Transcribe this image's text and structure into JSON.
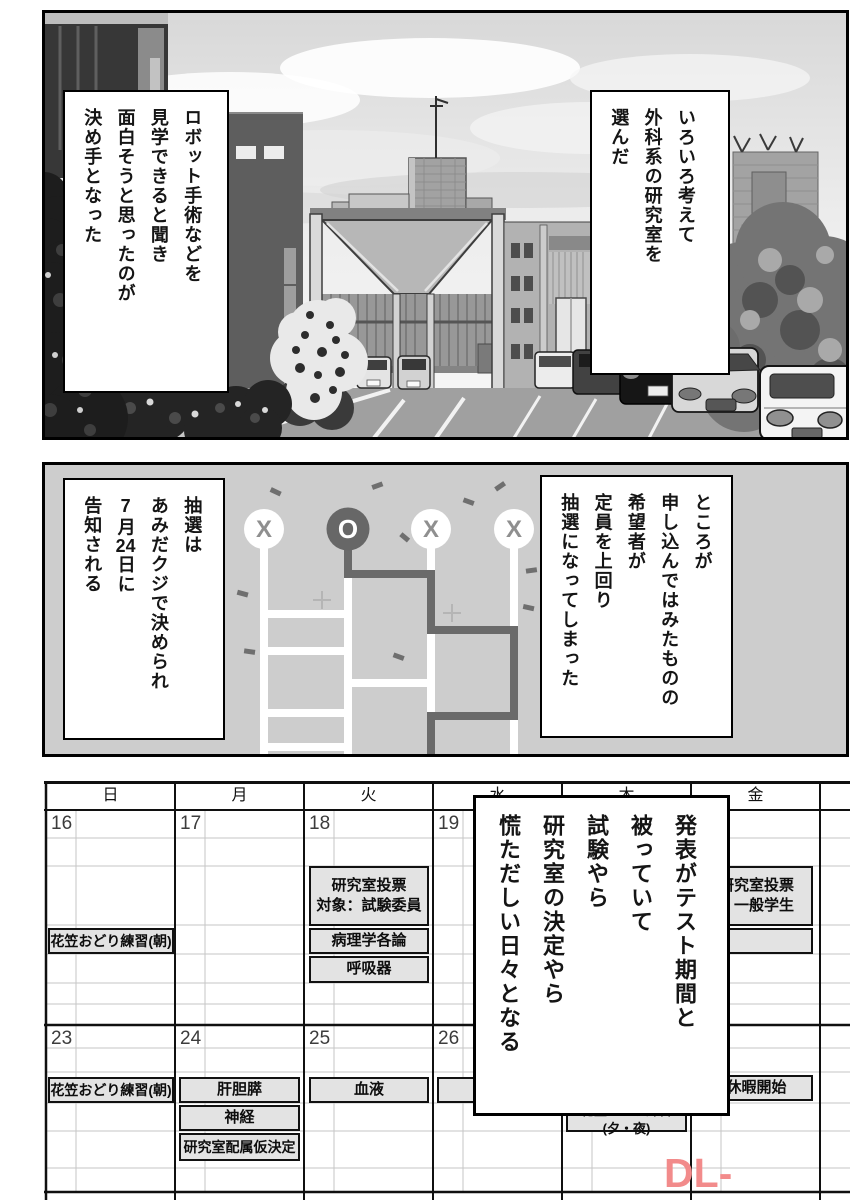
{
  "panel1": {
    "bubble_right": {
      "lines": [
        "いろいろ考えて",
        "外科系の研究室を",
        "選んだ"
      ]
    },
    "bubble_left": {
      "lines": [
        "ロボット手術などを",
        "見学できると聞き",
        "面白そうと思ったのが",
        "決め手となった"
      ]
    }
  },
  "panel2": {
    "bubble_right": {
      "lines": [
        "ところが",
        "申し込んではみたものの",
        "希望者が",
        "定員を上回り",
        "抽選になってしまった"
      ]
    },
    "bubble_left": {
      "lines": [
        "抽選は",
        "あみだクジで決められ",
        "7月24日に",
        "告知される"
      ]
    },
    "lottery": {
      "slots": [
        "X",
        "O",
        "X",
        "X"
      ]
    }
  },
  "panel3": {
    "narration": {
      "lines": [
        "発表がテスト期間と",
        "被っていて",
        "試験やら",
        "研究室の決定やら",
        "慌ただしい日々となる"
      ]
    },
    "calendar": {
      "day_headers": [
        "日",
        "月",
        "火",
        "水",
        "木",
        "金"
      ],
      "week1_dates": [
        "16",
        "17",
        "18",
        "19"
      ],
      "week2_dates": [
        "23",
        "24",
        "25",
        "26"
      ],
      "events": {
        "vote_committee": "研究室投票\n対象：試験委員",
        "vote_general": "研究室投票\n：一般学生",
        "hanagasa_morning_w1": "花笠おどり練習(朝)",
        "pathology": "病理学各論",
        "respiratory": "呼吸器",
        "hanagasa_morning_w2": "花笠おどり練習(朝)",
        "hepatobiliary": "肝胆膵",
        "blood": "血液",
        "vacation_start": "休暇開始",
        "nerve": "神経",
        "hanagasa_evening": "花笠おどり練習(夕・夜)",
        "lab_assignment_decision": "研究室配属仮決定"
      }
    }
  },
  "watermark": {
    "text": "DL-Raw.Se",
    "color": "#f28b8b"
  }
}
